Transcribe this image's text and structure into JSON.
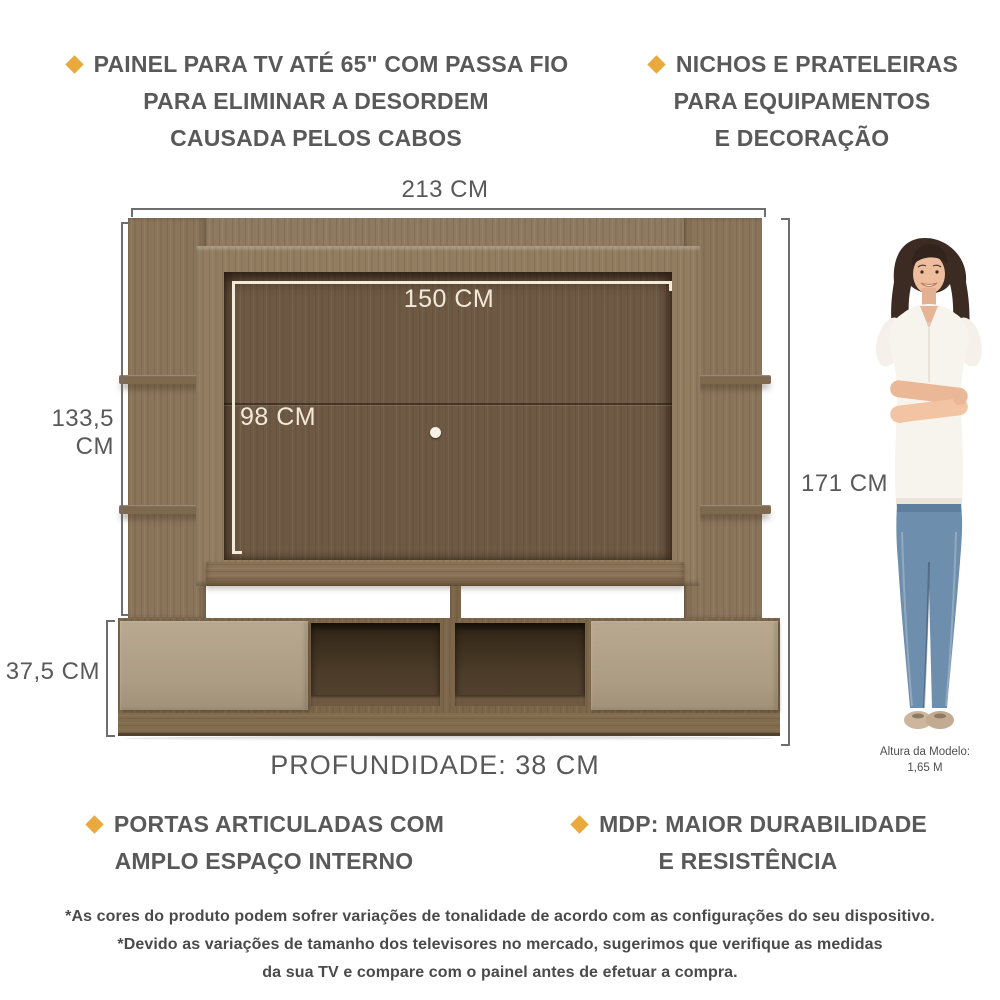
{
  "features": {
    "top_left": {
      "line1": "PAINEL PARA TV ATÉ 65\" COM PASSA FIO",
      "line2": "PARA ELIMINAR A DESORDEM",
      "line3": "CAUSADA PELOS CABOS"
    },
    "top_right": {
      "line1": "NICHOS E PRATELEIRAS",
      "line2": "PARA EQUIPAMENTOS",
      "line3": "E DECORAÇÃO"
    },
    "bottom_left": {
      "line1": "PORTAS ARTICULADAS COM",
      "line2": "AMPLO ESPAÇO INTERNO"
    },
    "bottom_right": {
      "line1": "MDP: MAIOR DURABILIDADE",
      "line2": "E RESISTÊNCIA"
    }
  },
  "dimensions": {
    "total_width": "213 CM",
    "inner_width": "150 CM",
    "inner_height": "98 CM",
    "panel_height": "133,5 CM",
    "total_height": "171 CM",
    "cabinet_height": "37,5 CM",
    "depth": "PROFUNDIDADE: 38 CM"
  },
  "model_caption": {
    "line1": "Altura da Modelo:",
    "line2": "1,65 M"
  },
  "disclaimer": {
    "line1": "*As cores do produto podem sofrer variações de tonalidade de acordo com as configurações do seu dispositivo.",
    "line2": "*Devido as variações de tamanho dos televisores no mercado, sugerimos que verifique as medidas",
    "line3": "da sua TV e compare com o painel antes de efetuar a compra."
  },
  "colors": {
    "accent": "#E9A93D",
    "text": "#595959",
    "wood_light": "#8E7A60",
    "wood_dark": "#6E5A44",
    "door_beige": "#B1A28A",
    "dimension_line": "#6E6E6E",
    "white_dimension": "#F2E9D9",
    "jeans_blue": "#6C8DAC"
  }
}
